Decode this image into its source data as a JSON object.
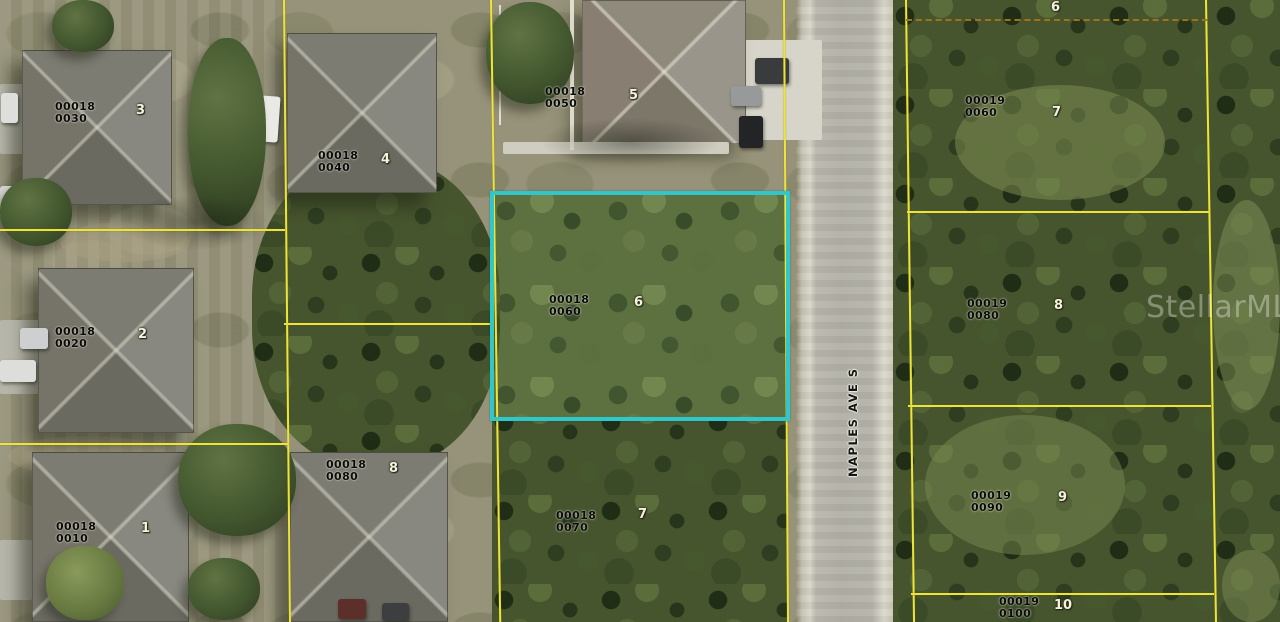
{
  "street": {
    "name": "NAPLES AVE S"
  },
  "watermark": "StellarMLS",
  "colors": {
    "parcel_line": "#ede43b",
    "highlight_outline": "#2fc7ca",
    "dashed_boundary": "#9c741c"
  },
  "highlighted_parcel": {
    "id": "00018-0060",
    "lot": "6"
  },
  "parcels": [
    {
      "id_line1": "00018",
      "id_line2": "0030",
      "lot": "3"
    },
    {
      "id_line1": "00018",
      "id_line2": "0040",
      "lot": "4"
    },
    {
      "id_line1": "00018",
      "id_line2": "0050",
      "lot": "5"
    },
    {
      "id_line1": "00018",
      "id_line2": "0060",
      "lot": "6"
    },
    {
      "id_line1": "00018",
      "id_line2": "0070",
      "lot": "7"
    },
    {
      "id_line1": "00018",
      "id_line2": "0080",
      "lot": "8"
    },
    {
      "id_line1": "00018",
      "id_line2": "0020",
      "lot": "2"
    },
    {
      "id_line1": "00018",
      "id_line2": "0010",
      "lot": "1"
    },
    {
      "id_line1": "00019",
      "id_line2": "0060",
      "lot": "7"
    },
    {
      "id_line1": "00019",
      "id_line2": "0080",
      "lot": "8"
    },
    {
      "id_line1": "00019",
      "id_line2": "0090",
      "lot": "9"
    },
    {
      "id_line1": "00019",
      "id_line2": "0100",
      "lot": "10"
    }
  ],
  "unlabeled_lot_numbers": [
    {
      "lot": "6"
    }
  ]
}
